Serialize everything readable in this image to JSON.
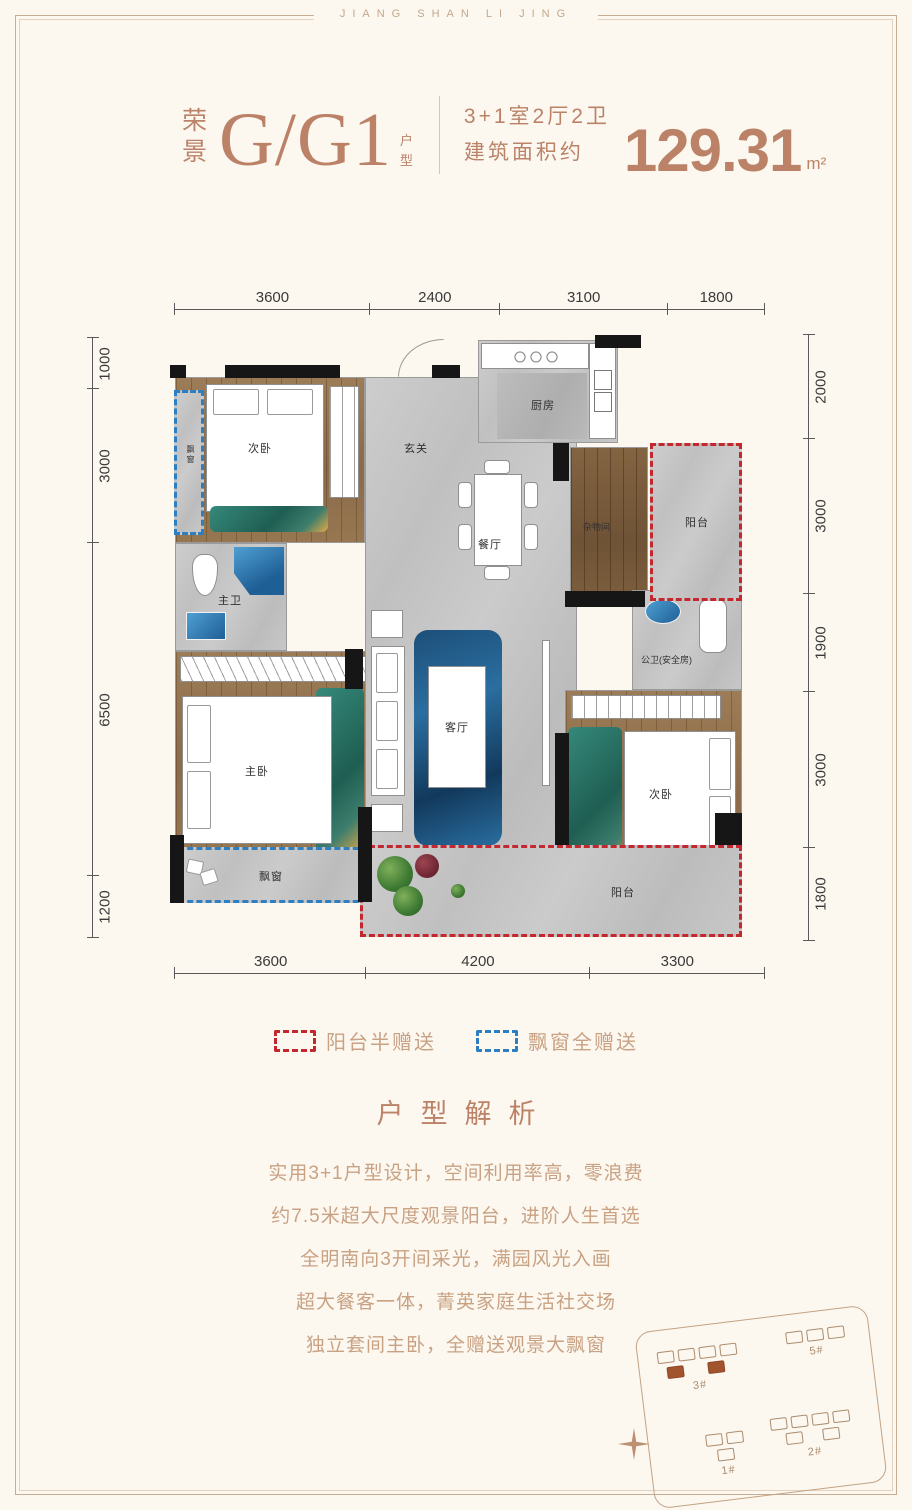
{
  "banner": "JIANG SHAN LI JING",
  "header": {
    "prefix_chars": [
      "荣",
      "景"
    ],
    "unit_name": "G/G1",
    "suffix_chars": [
      "户",
      "型"
    ],
    "spec_line1": "3+1室2厅2卫",
    "spec_line2": "建筑面积约",
    "area_value": "129.31",
    "area_unit": "m²"
  },
  "plan": {
    "dims_top": [
      "3600",
      "2400",
      "3100",
      "1800"
    ],
    "dims_bottom": [
      "3600",
      "4200",
      "3300"
    ],
    "dims_left": [
      "1000",
      "3000",
      "6500",
      "1200"
    ],
    "dims_right": [
      "2000",
      "3000",
      "1900",
      "3000",
      "1800"
    ],
    "rooms": {
      "bedroom_top": "次卧",
      "bay_top": "飘窗",
      "entry": "玄关",
      "kitchen": "厨房",
      "dining": "餐厅",
      "storage": "杂物间",
      "balcony_top": "阳台",
      "master_bath": "主卫",
      "guest_bath": "公卫(安全房)",
      "master_bedroom": "主卧",
      "living": "客厅",
      "bedroom_right": "次卧",
      "bay_bottom": "飘窗",
      "balcony_bottom": "阳台"
    }
  },
  "legend": {
    "balcony_label": "阳台半赠送",
    "bay_label": "飘窗全赠送",
    "balcony_color": "#c4282f",
    "bay_color": "#2d7fc1"
  },
  "analysis": {
    "title": "户型解析",
    "lines": [
      "实用3+1户型设计，空间利用率高，零浪费",
      "约7.5米超大尺度观景阳台，进阶人生首选",
      "全明南向3开间采光，满园风光入画",
      "超大餐客一体，菁英家庭生活社交场",
      "独立套间主卧，全赠送观景大飘窗"
    ]
  },
  "site_plan": {
    "labels": [
      "3#",
      "5#",
      "1#",
      "2#"
    ]
  },
  "colors": {
    "accent": "#bb8268",
    "background": "#fcf8f0",
    "red_dash": "#c4282f",
    "blue_dash": "#2d7fc1"
  }
}
